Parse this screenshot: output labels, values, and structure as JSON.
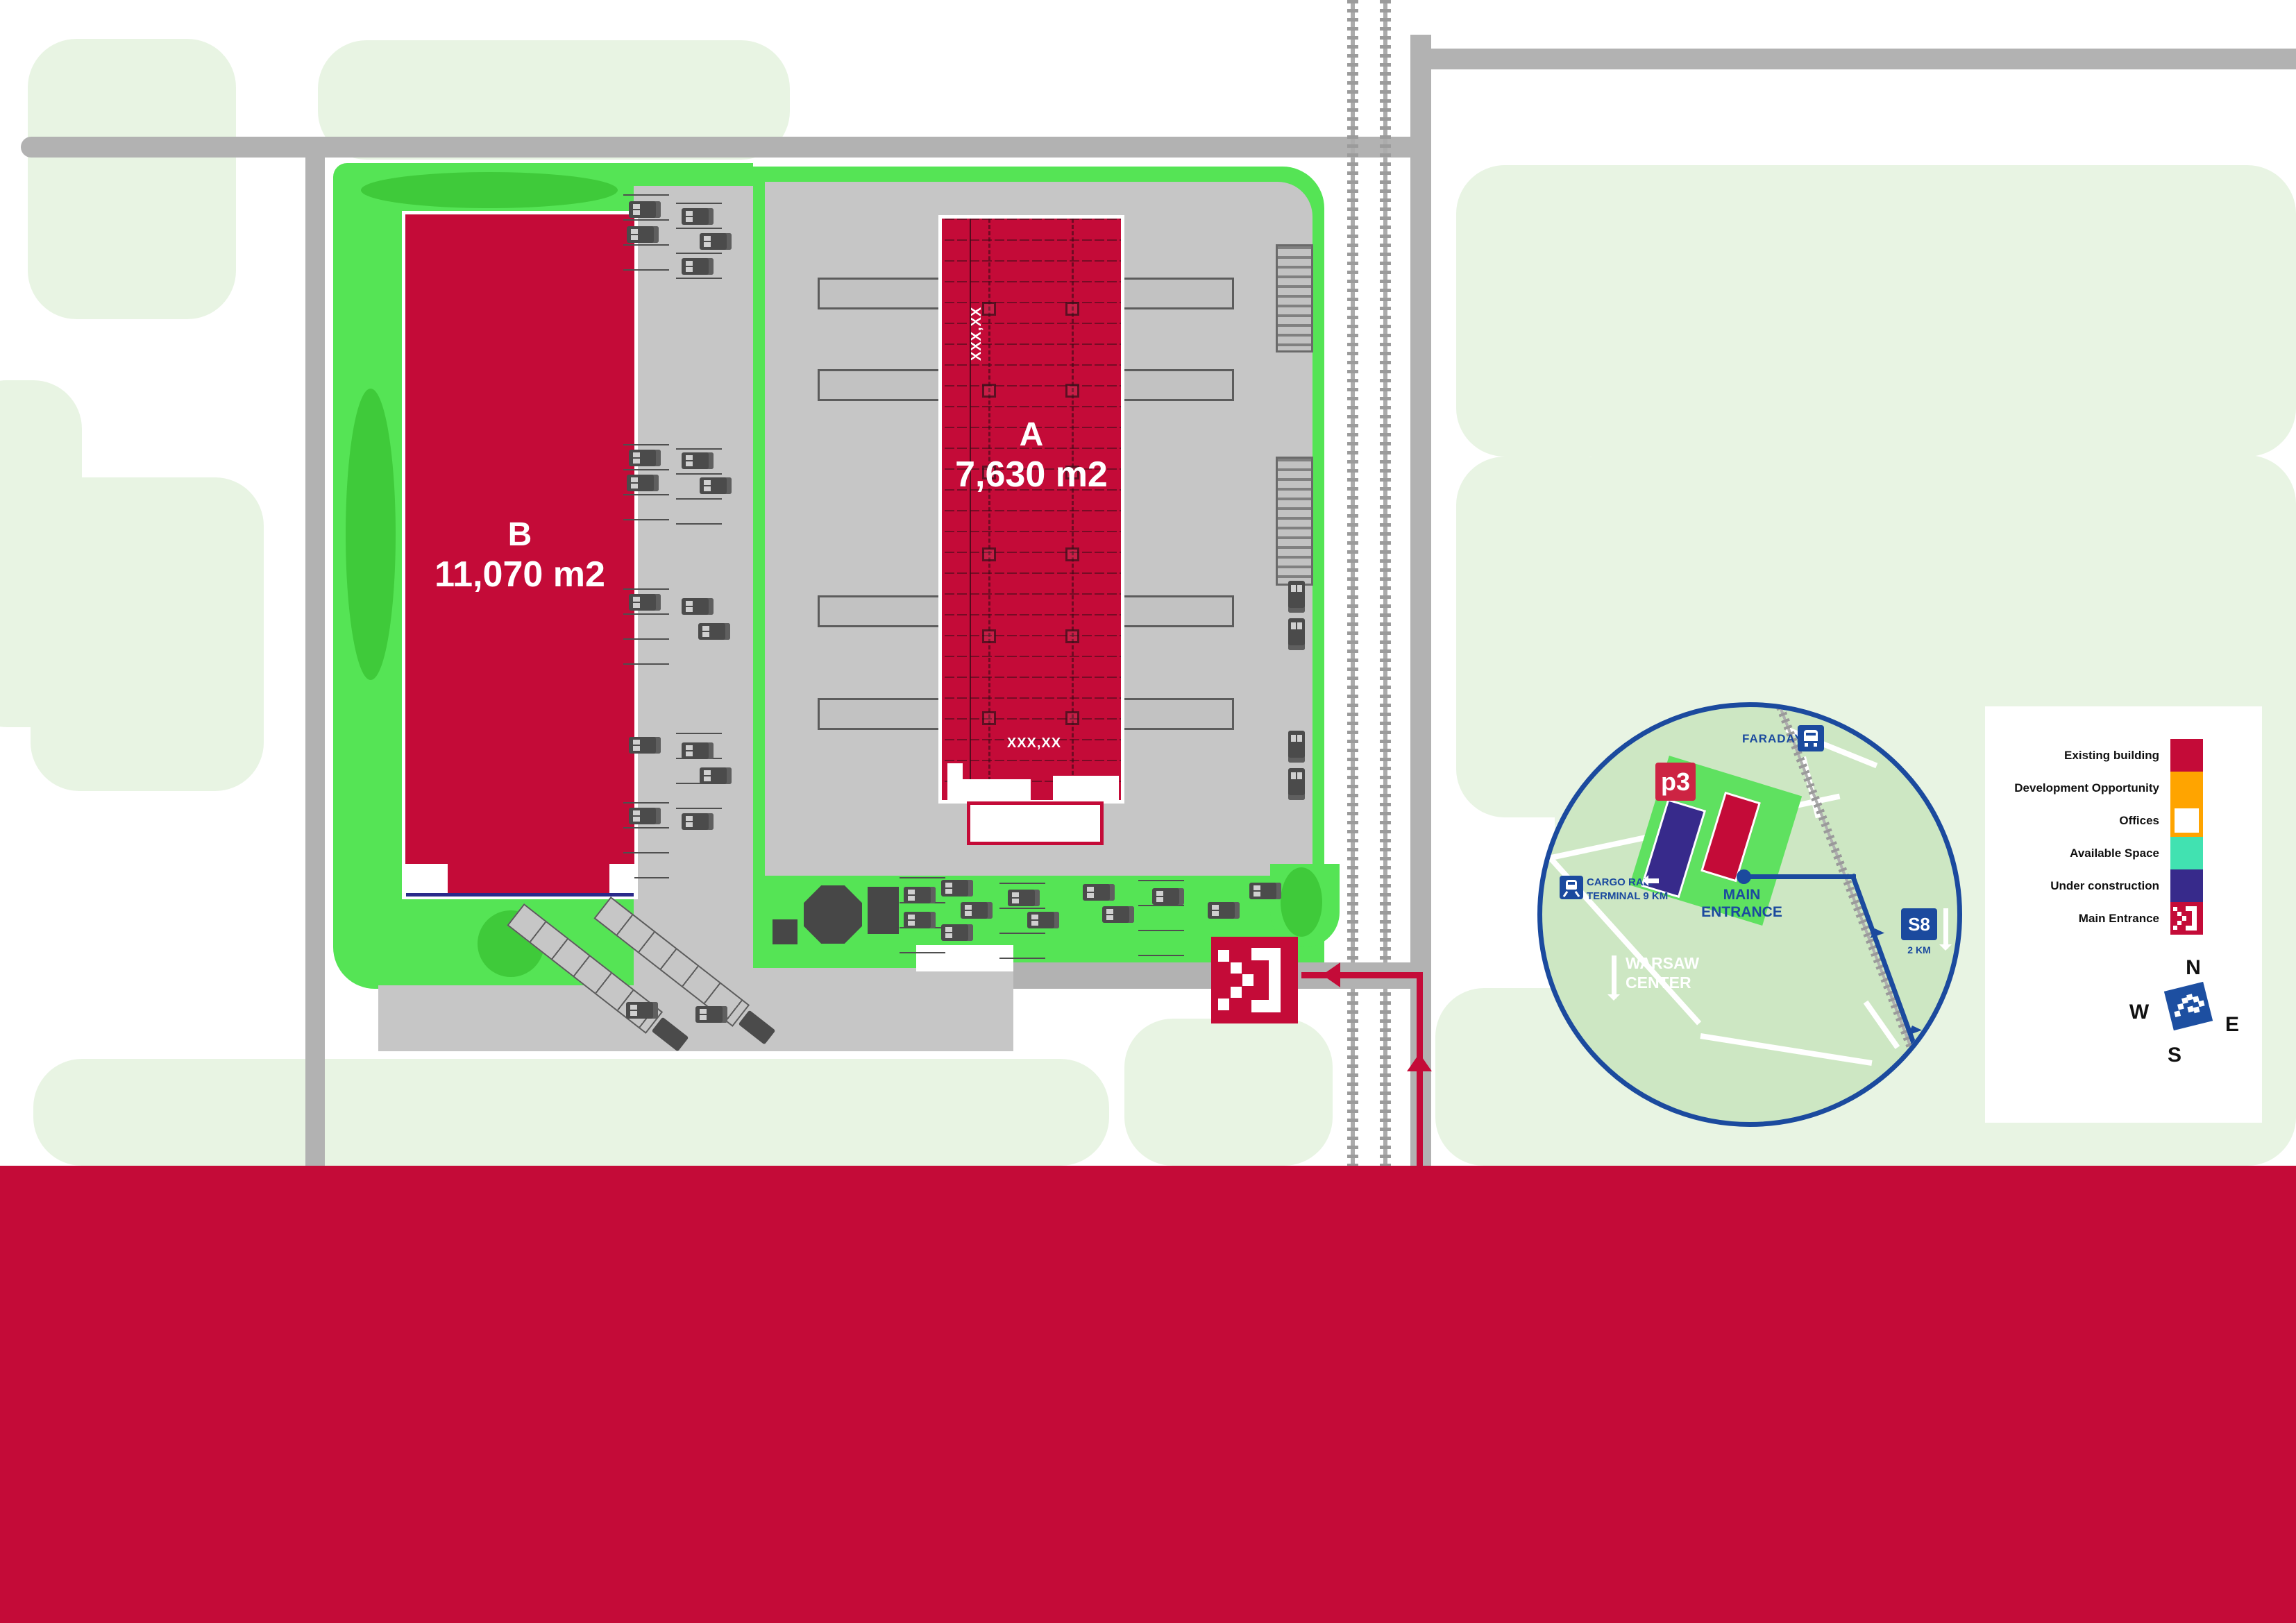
{
  "brand": {
    "logo_text": "p3"
  },
  "site_plan": {
    "building_a": {
      "id": "A",
      "area_label": "7,630 m2",
      "placeholder_vertical": "XXX,XX",
      "placeholder_bottom": "XXX,XX"
    },
    "building_b": {
      "id": "B",
      "area_label": "11,070 m2"
    }
  },
  "location_map": {
    "street_top": "FARADAYA",
    "cargo_rail": {
      "line1": "CARGO RAIL",
      "line2": "TERMINAL 9 KM"
    },
    "main_entrance_label": "MAIN ENTRANCE",
    "warsaw_center": {
      "line1": "WARSAW",
      "line2": "CENTER"
    },
    "s8": {
      "sign": "S8",
      "distance": "2 KM"
    }
  },
  "legend": {
    "items": [
      {
        "label": "Existing building",
        "color": "#c40b38",
        "type": "fill"
      },
      {
        "label": "Development Opportunity",
        "color": "#ffa400",
        "type": "fill"
      },
      {
        "label": "Offices",
        "color": "#ffffff",
        "border": "#ffa400",
        "type": "outline"
      },
      {
        "label": "Available Space",
        "color": "#41e2b1",
        "type": "fill"
      },
      {
        "label": "Under construction",
        "color": "#372a8b",
        "type": "fill"
      },
      {
        "label": "Main Entrance",
        "color": "#c40b38",
        "type": "entrance-icon"
      }
    ]
  },
  "compass": {
    "n": "N",
    "e": "E",
    "s": "S",
    "w": "W"
  },
  "colors": {
    "existing_building": "#c40b38",
    "development_opportunity": "#ffa400",
    "available_space": "#41e2b1",
    "under_construction": "#372a8b",
    "map_blue": "#1b4a9e",
    "bright_green": "#55e455",
    "pale_green": "#e8f4e3",
    "road_gray": "#b2b2b2",
    "yard_gray": "#c6c6c6"
  }
}
